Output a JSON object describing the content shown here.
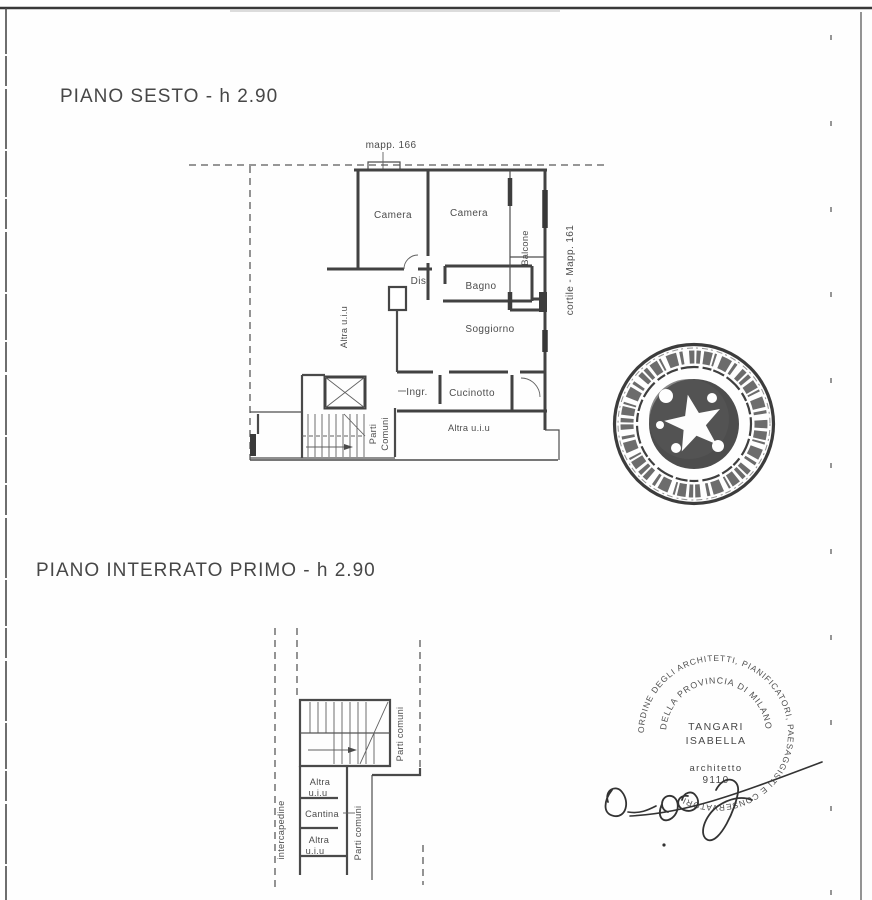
{
  "page": {
    "background": "#fefefe",
    "ink": "#454545"
  },
  "titles": {
    "plan1": "PIANO SESTO - h 2.90",
    "plan2": "PIANO INTERRATO PRIMO - h 2.90"
  },
  "plan1": {
    "mapp_top": "mapp. 166",
    "cortile_right": "cortile - Mapp. 161",
    "camera1": "Camera",
    "camera2": "Camera",
    "balcone": "Balcone",
    "dis": "Dis.",
    "bagno": "Bagno",
    "soggiorno": "Soggiorno",
    "ingresso": "Ingr.",
    "cucinotto": "Cucinotto",
    "altra_uiu_left": "Altra u.i.u",
    "altra_uiu_bottom": "Altra u.i.u",
    "parti_comuni_line1": "Parti",
    "parti_comuni_line2": "Comuni"
  },
  "plan2": {
    "intercapedine": "intercapedine",
    "cantina": "Cantina",
    "altra_top_line1": "Altra",
    "altra_top_line2": "u.i.u",
    "altra_bottom_line1": "Altra",
    "altra_bottom_line2": "u.i.u",
    "parti_comuni_stairs": "Parti comuni",
    "parti_comuni_corridor": "Parti comuni"
  },
  "architect_stamp": {
    "ring": "ORDINE DEGLI ARCHITETTI, PIANIFICATORI, PAESAGGISTI E CONSERVATORI",
    "inner_arc": "DELLA PROVINCIA DI MILANO",
    "name_line1": "TANGARI",
    "name_line2": "ISABELLA",
    "role": "architetto",
    "registration_number": "9110"
  }
}
